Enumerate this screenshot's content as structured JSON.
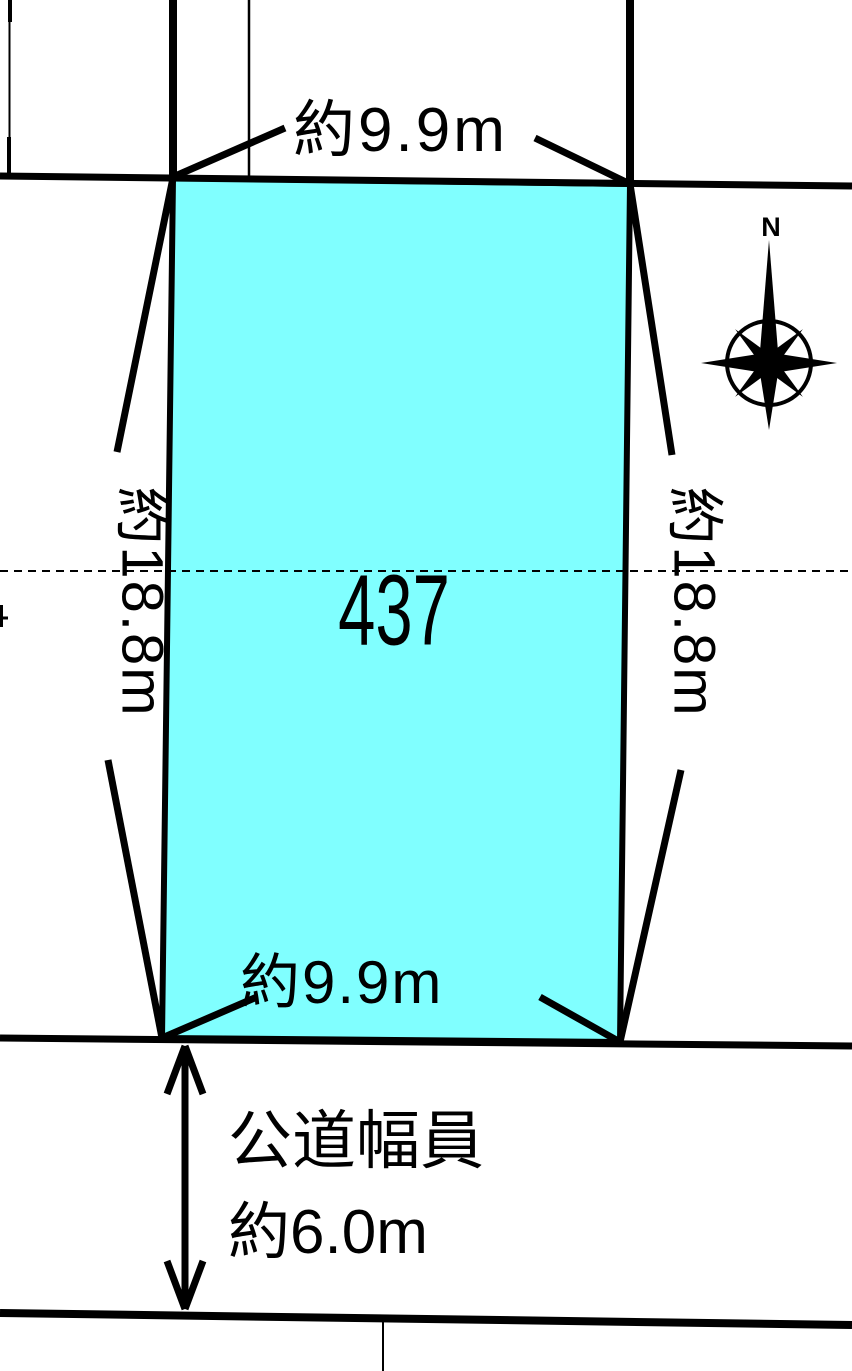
{
  "diagram": {
    "lot": {
      "number": "437",
      "frontage_top": "約9.9m",
      "frontage_bottom": "約9.9m",
      "depth_left": "約18.8m",
      "depth_right": "約18.8m"
    },
    "road": {
      "width_label_line1": "公道幅員",
      "width_label_line2": "約6.0m"
    },
    "compass": {
      "north": "N"
    },
    "colors": {
      "lot_fill": "#80ffff",
      "line": "#000000",
      "background": "#ffffff"
    }
  }
}
